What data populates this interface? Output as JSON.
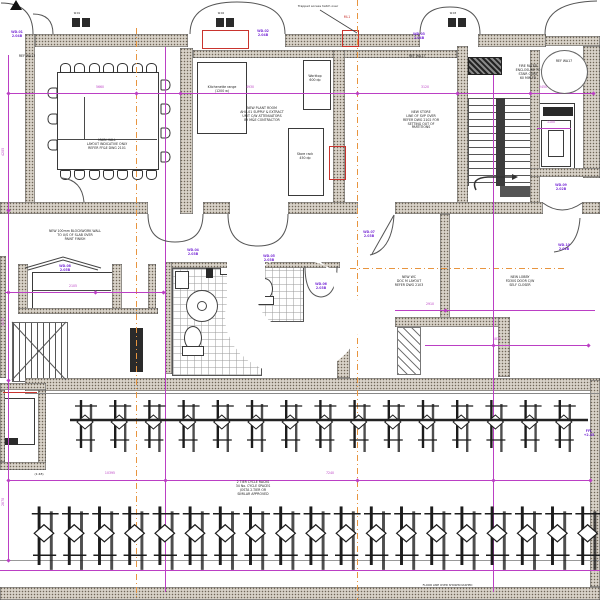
{
  "colors": {
    "wall": "#d8d2c8",
    "line": "#4a4a4a",
    "magenta": "#bb3fc4",
    "purple": "#7a2fd6",
    "orange": "#e8953f",
    "red": "#c9342e"
  },
  "labels": {
    "ref_left": "REF WA17",
    "ref_store": "REF WA17",
    "ref_bubble": "REF WA17",
    "leader_note": "Trapped access hatch over",
    "red_tag": "ML1",
    "scale_note": "(1:48)",
    "bottom_line_note": "FLOOR LINE OVER SHOWN DASHED"
  },
  "notes": [
    {
      "text": "MAIN HALL\nLAYOUT INDICATIVE ONLY\nREFER FF&E DWG 2101",
      "x": 62,
      "y": 139,
      "w": 90
    },
    {
      "text": "NEW PLANT ROOM\nAHU-01 SUPPLY & EXTRACT\nUNIT C/W ATTENUATORS\nBY M&E CONTRACTOR",
      "x": 212,
      "y": 107,
      "w": 100
    },
    {
      "text": "NEW STORE\nLINE OF SVP OVER\nREFER DWG 2102 FOR\nSETTING OUT OF\nPARTITIONS",
      "x": 394,
      "y": 111,
      "w": 54
    },
    {
      "text": "FIRE RATED\nENCLOSURE TO\nSTAIR CORE\n60 MIN FR",
      "x": 503,
      "y": 65,
      "w": 50
    },
    {
      "text": "NEW 100mm BLOCKWORK WALL\nTO U/S OF SLAB OVER\nPAINT FINISH",
      "x": 28,
      "y": 230,
      "w": 94
    },
    {
      "text": "NEW WC\nDOC M LAYOUT\nREFER DWG 2103",
      "x": 382,
      "y": 276,
      "w": 54
    },
    {
      "text": "NEW LOBBY\nFD30S DOOR C/W\nSELF CLOSER",
      "x": 494,
      "y": 276,
      "w": 52
    },
    {
      "text": "2 TIER CYCLE RACKS\n34 No. CYCLE SPACES\nJOSTA 2-TIER OR\nSIMILAR APPROVED",
      "x": 220,
      "y": 481,
      "w": 66
    },
    {
      "text": "Kitchenette range\n(1200 w)",
      "x": 198,
      "y": 86,
      "w": 48
    },
    {
      "text": "Worktop\n600 dp",
      "x": 299,
      "y": 75,
      "w": 32
    },
    {
      "text": "Store rack\n450 dp",
      "x": 287,
      "y": 153,
      "w": 36
    }
  ],
  "tags": [
    {
      "text": "WD.01\n2.04B",
      "x": 4,
      "y": 31
    },
    {
      "text": "WD.02\n2.04B",
      "x": 250,
      "y": 30
    },
    {
      "text": "WD.03\n2.04B",
      "x": 406,
      "y": 33
    },
    {
      "text": "WD.04\n2.03B",
      "x": 180,
      "y": 249
    },
    {
      "text": "WD.05\n2.03B",
      "x": 256,
      "y": 255
    },
    {
      "text": "WD.06\n2.03B",
      "x": 308,
      "y": 283
    },
    {
      "text": "WD.07\n2.03B",
      "x": 356,
      "y": 231
    },
    {
      "text": "WD.08\n2.05B",
      "x": 52,
      "y": 265
    },
    {
      "text": "WD.09\n2.02B",
      "x": 548,
      "y": 184
    },
    {
      "text": "WD.10\n2.02B",
      "x": 551,
      "y": 244
    },
    {
      "text": "FFL\n+2.35",
      "x": 576,
      "y": 430
    }
  ],
  "dims": [
    {
      "text": "5660",
      "x": 90,
      "y": 86
    },
    {
      "text": "4930",
      "x": 240,
      "y": 86
    },
    {
      "text": "3120",
      "x": 415,
      "y": 86
    },
    {
      "text": "2450",
      "x": 533,
      "y": 86
    },
    {
      "text": "2105",
      "x": 63,
      "y": 285
    },
    {
      "text": "2910",
      "x": 420,
      "y": 303
    },
    {
      "text": "1830",
      "x": 487,
      "y": 338
    },
    {
      "text": "1100",
      "x": 541,
      "y": 121
    },
    {
      "text": "10395",
      "x": 100,
      "y": 472
    },
    {
      "text": "7240",
      "x": 320,
      "y": 472
    },
    {
      "text": "4205",
      "x": -6,
      "y": 150,
      "rot": 1
    },
    {
      "text": "3470",
      "x": -6,
      "y": 320,
      "rot": 1
    },
    {
      "text": "2870",
      "x": -6,
      "y": 500,
      "rot": 1
    }
  ],
  "micro": [
    {
      "text": "W.01",
      "x": 68,
      "y": 12
    },
    {
      "text": "W.02",
      "x": 212,
      "y": 12
    },
    {
      "text": "W.03",
      "x": 444,
      "y": 12
    }
  ],
  "bike_rows": [
    {
      "count": 15,
      "label": "upper cycle rack row"
    },
    {
      "count": 19,
      "label": "lower cycle rack row"
    }
  ]
}
